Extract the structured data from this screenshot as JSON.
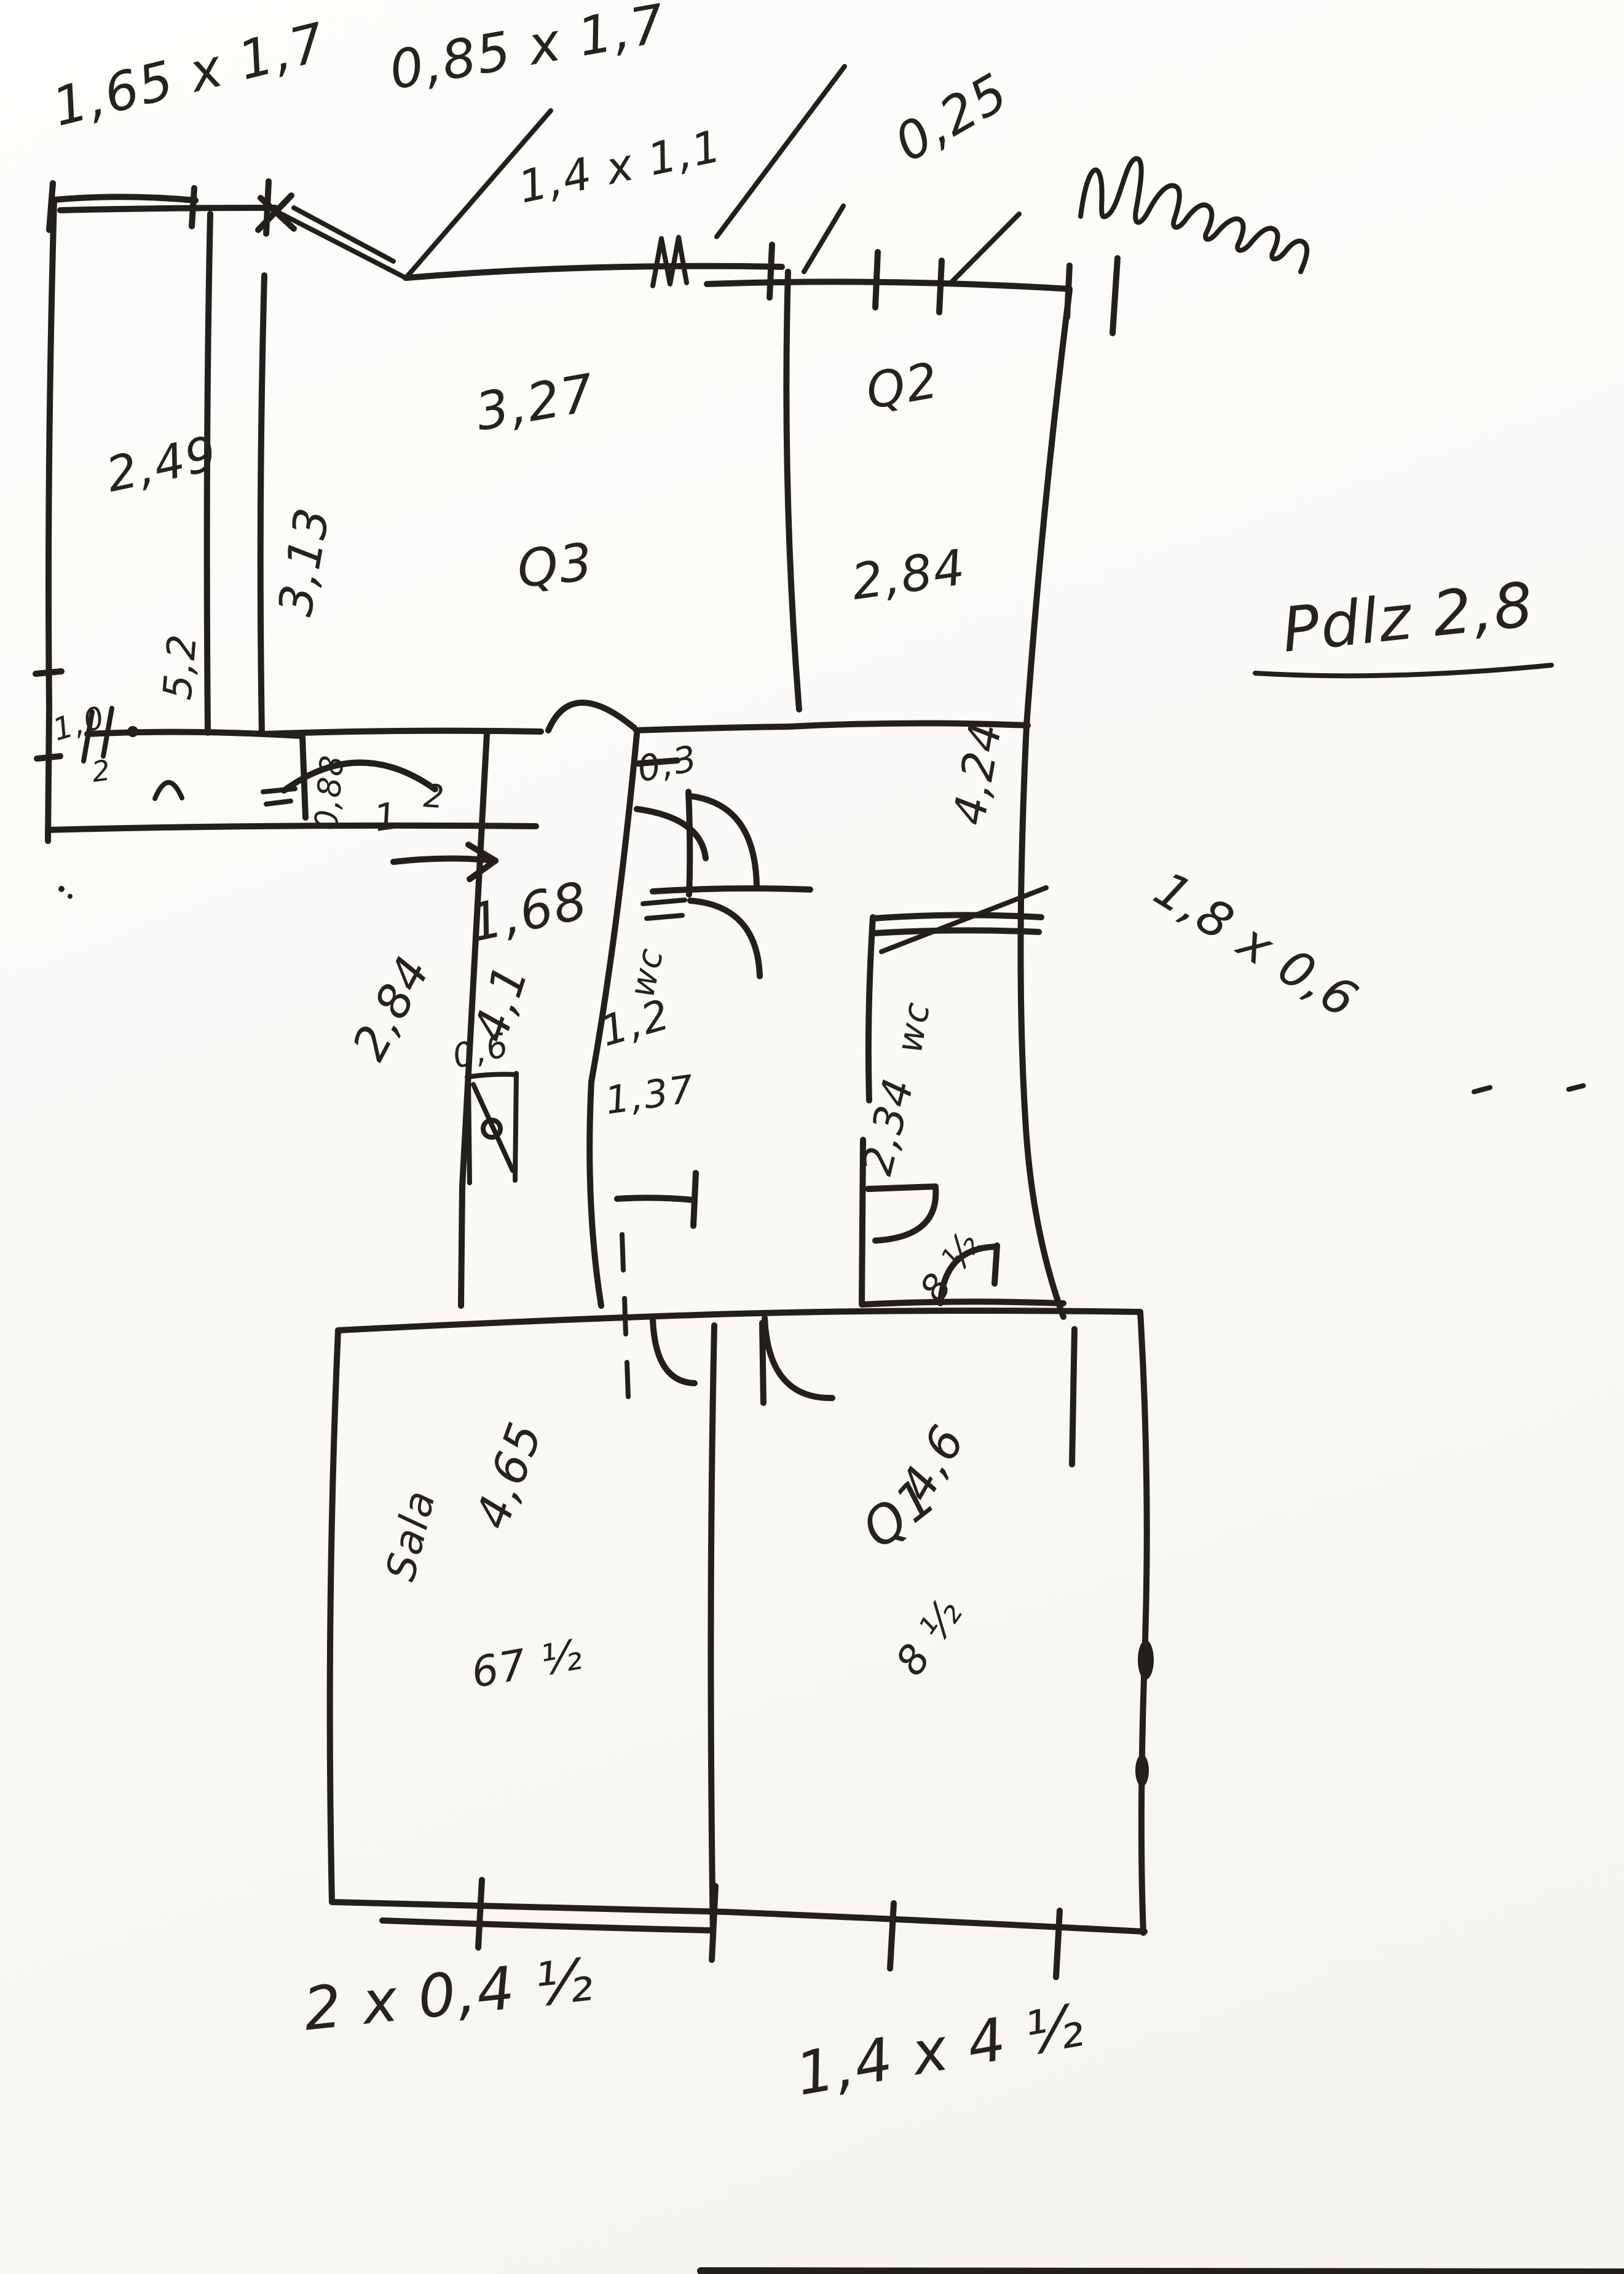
{
  "meta": {
    "description": "Hand-drawn floor plan sketch, black ink on white scanned paper",
    "ink_color": "#221f1c",
    "paper_color": "#fcfbf8",
    "scribbles": {
      "top_right_word": "(illegible cursive scribble)"
    }
  },
  "labels": {
    "win_left": "1,65 x 1,7",
    "win_left2": "0,85 x 1,7",
    "win_mid": "1,4 x 1,1",
    "dim_025": "0,25",
    "room_left_w": "2,49",
    "room_left_h": "5,2",
    "room_q3_left": "3,13",
    "room_q3_w": "3,27",
    "room_q3": "Q3",
    "room_q2": "Q2",
    "room_q2_w": "2,84",
    "room_q2_h": "4,24",
    "note_pdz": "Pdlz 2,8",
    "hall_088": "0,88",
    "hall_1": "1",
    "hall_2": "2",
    "alc_10": "1,0",
    "alc_2": "2",
    "dim_03": "0,3",
    "cor_w": "1,68",
    "cor_h": "4,1",
    "cor_left_h": "2,84",
    "dim_06": "0,6",
    "wc_small": "wc",
    "wc_small_w": "1,2",
    "wc_small_d": "1,37",
    "wc_big": "wc",
    "wc_big_h": "2,34",
    "dim_18x06": "1,8 x 0,6",
    "wc_door": "8 ½",
    "sala": "Sala",
    "sala_w": "4,65",
    "sala_b": "67 ½",
    "q1": "Q1",
    "q1_h": "4,6",
    "q1_b": "8 ½",
    "bottom_left_note": "2 x 0,4 ½",
    "bottom_right_note": "1,4 x 4 ½"
  }
}
